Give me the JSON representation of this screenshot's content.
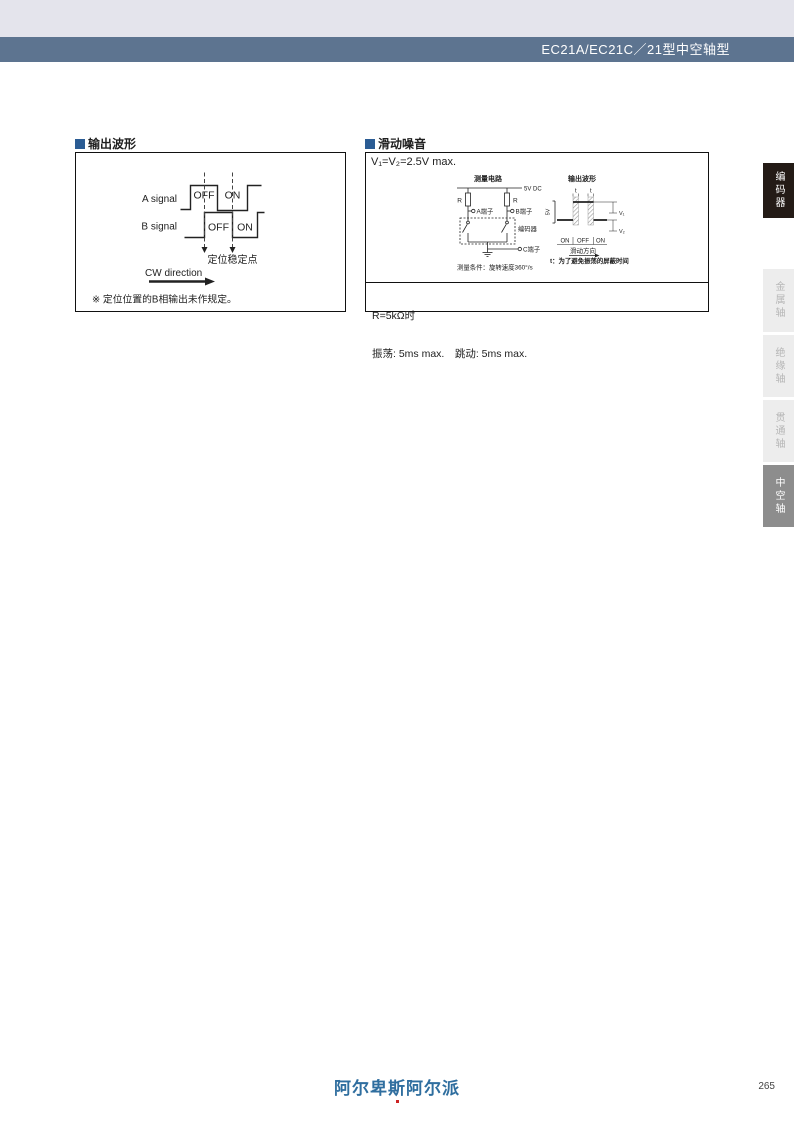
{
  "header": {
    "title": "EC21A/EC21C／21型中空轴型"
  },
  "output_waveform": {
    "heading": "输出波形",
    "signal_a_label": "A signal",
    "signal_b_label": "B signal",
    "a_off": "OFF",
    "a_on": "ON",
    "b_off": "OFF",
    "b_on": "ON",
    "stable_point_label": "定位稳定点",
    "cw_label": "CW direction",
    "note": "※ 定位位置的B相输出未作规定。"
  },
  "sliding_noise": {
    "heading": "滑动噪音",
    "condition": "V₁=V₂=2.5V max.",
    "circuit": {
      "title": "测量电路",
      "supply": "5V DC",
      "r_left": "R",
      "r_right": "R",
      "terminal_a": "A端子",
      "terminal_b": "B端子",
      "terminal_c": "C端子",
      "encoder_label": "编码器",
      "condition_note": "测量条件：旋转速度360°/s"
    },
    "waveform": {
      "title": "输出波形",
      "axis_label": "5V",
      "t_left": "t",
      "t_right": "t",
      "v1": "V₁",
      "v2": "V₂",
      "on_left": "ON",
      "off": "OFF",
      "on_right": "ON",
      "direction_label": "滑动方向",
      "mask_note": "t：为了避免振荡的屏蔽时间"
    },
    "result_line1": "R=5kΩ时",
    "result_line2": "振荡: 5ms max.　跳动: 5ms max."
  },
  "sidebar": {
    "tabs": [
      {
        "label": "编码器",
        "state": "active-dark"
      },
      {
        "label": "金属轴",
        "state": "inactive"
      },
      {
        "label": "绝缘轴",
        "state": "inactive"
      },
      {
        "label": "贯通轴",
        "state": "inactive"
      },
      {
        "label": "中空轴",
        "state": "active-grey"
      }
    ]
  },
  "footer": {
    "logo_text": "阿尔卑斯阿尔派",
    "page_number": "265"
  },
  "colors": {
    "header_bar": "#5d7490",
    "top_band": "#e4e4ec",
    "accent_square": "#2b5c94",
    "tab_dark": "#241b16",
    "tab_inactive_bg": "#ededed",
    "tab_active_bg": "#8d8d8d",
    "logo_blue": "#2f6e9f"
  }
}
